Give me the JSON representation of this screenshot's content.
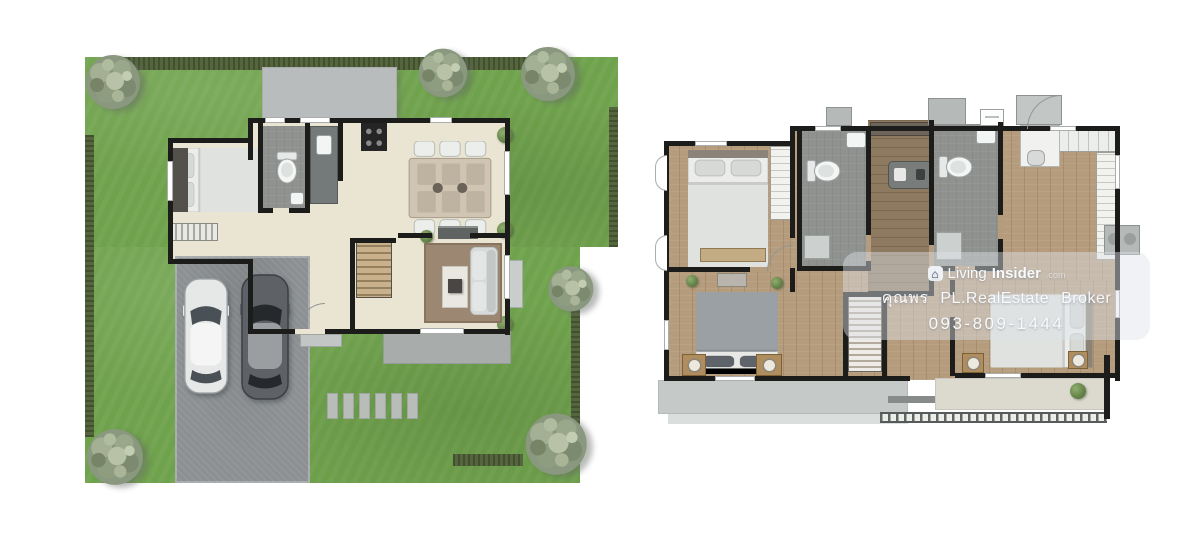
{
  "page": {
    "background": "#ffffff"
  },
  "watermark": {
    "logo_glyph": "⌂",
    "brand_prefix": "Living",
    "brand_suffix": "Insider",
    "brand_tld": ".com",
    "agent_line": "คุณพร PL.RealEstate Broker",
    "phone": "093-809-1444"
  },
  "colors": {
    "lawn": "#6fa24c",
    "hedge": "#55663e",
    "canopy": "#b8bcbc",
    "floor": "#eae4d2",
    "wall": "#1c1c1a",
    "bath": "#8f928f",
    "counter": "#74797a",
    "drive": "#8c9092",
    "terrace": "#a8acab",
    "wood": "#b59c7c",
    "woodDark": "#8d7a60",
    "balcony": "#c5c9c7",
    "stone": "#b9bdb9",
    "wmBg": "rgba(222,226,233,0.45)",
    "wmText": "#f8fafc"
  }
}
